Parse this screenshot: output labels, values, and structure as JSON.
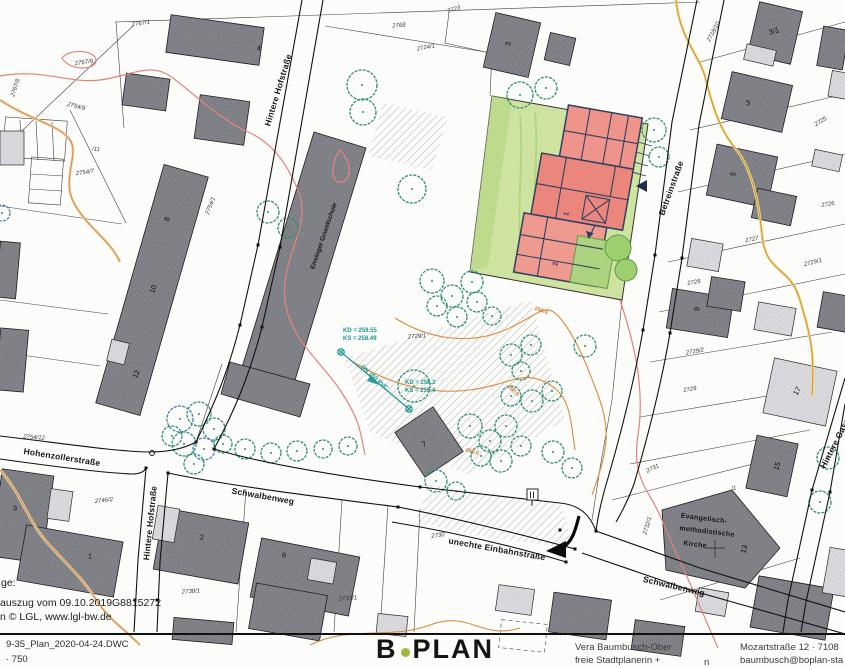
{
  "map": {
    "labels": [
      {
        "t": "Hintere Hofstraße",
        "x": 278,
        "y": 90,
        "r": -73,
        "c": "street",
        "n": "street-label-hintere-hofstrasse-north"
      },
      {
        "t": "Hintere Hofstraße",
        "x": 150,
        "y": 523,
        "r": -84,
        "c": "street",
        "n": "street-label-hintere-hofstrasse-south"
      },
      {
        "t": "Hohenzollerstraße",
        "x": 62,
        "y": 457,
        "r": 9,
        "c": "street",
        "n": "street-label-hohenzollerstrasse"
      },
      {
        "t": "Schwalbenweg",
        "x": 263,
        "y": 496,
        "r": 10,
        "c": "street",
        "n": "street-label-schwalbenweg-west"
      },
      {
        "t": "unechte Einbahnstraße",
        "x": 497,
        "y": 549,
        "r": 10,
        "c": "street",
        "n": "street-label-unechte-einbahnstrasse"
      },
      {
        "t": "Schwalbenweg",
        "x": 674,
        "y": 586,
        "r": 13,
        "c": "street",
        "n": "street-label-schwalbenweg-east"
      },
      {
        "t": "Betreinstraße",
        "x": 671,
        "y": 188,
        "r": -70,
        "c": "street",
        "n": "street-label-betreinstrasse"
      },
      {
        "t": "Hintere Gasse",
        "x": 836,
        "y": 441,
        "r": -63,
        "c": "street",
        "n": "street-label-hintere-gasse"
      },
      {
        "t": "Ensinger Grundschule",
        "x": 324,
        "y": 236,
        "r": -71,
        "c": "bname",
        "n": "building-label-grundschule"
      },
      {
        "t": "Evangelisch-",
        "x": 704,
        "y": 519,
        "r": 7,
        "c": "bname kirche",
        "n": "building-label-kirche-1"
      },
      {
        "t": "methodistische",
        "x": 707,
        "y": 532,
        "r": 7,
        "c": "bname kirche",
        "n": "building-label-kirche-2"
      },
      {
        "t": "Kirche",
        "x": 695,
        "y": 545,
        "r": 7,
        "c": "bname kirche",
        "n": "building-label-kirche-3"
      },
      {
        "t": "2767/1",
        "x": 141,
        "y": 24,
        "r": -8,
        "c": "parcel"
      },
      {
        "t": "2768",
        "x": 399,
        "y": 26,
        "r": -4,
        "c": "parcel"
      },
      {
        "t": "2767/9",
        "x": 84,
        "y": 63,
        "r": -8,
        "c": "parcel"
      },
      {
        "t": "2767/8",
        "x": 16,
        "y": 88,
        "r": -72,
        "c": "parcel"
      },
      {
        "t": "2754/9",
        "x": 76,
        "y": 107,
        "r": 14,
        "c": "parcel"
      },
      {
        "t": "/11",
        "x": 96,
        "y": 150,
        "r": 5,
        "c": "parcel"
      },
      {
        "t": "2754/7",
        "x": 85,
        "y": 173,
        "r": -8,
        "c": "parcel"
      },
      {
        "t": "2754/1",
        "x": 211,
        "y": 206,
        "r": -68,
        "c": "parcel"
      },
      {
        "t": "2754/12",
        "x": 34,
        "y": 438,
        "r": 4,
        "c": "parcel"
      },
      {
        "t": "2746/2",
        "x": 104,
        "y": 501,
        "r": -6,
        "c": "parcel"
      },
      {
        "t": "2738/1",
        "x": 191,
        "y": 592,
        "r": -4,
        "c": "parcel"
      },
      {
        "t": "2737/1",
        "x": 348,
        "y": 599,
        "r": -4,
        "c": "parcel"
      },
      {
        "t": "2723",
        "x": 454,
        "y": 10,
        "r": -16,
        "c": "parcel"
      },
      {
        "t": "2724/1",
        "x": 426,
        "y": 48,
        "r": -10,
        "c": "parcel"
      },
      {
        "t": "2725",
        "x": 821,
        "y": 122,
        "r": -32,
        "c": "parcel"
      },
      {
        "t": "2726",
        "x": 828,
        "y": 205,
        "r": -10,
        "c": "parcel"
      },
      {
        "t": "2727",
        "x": 752,
        "y": 240,
        "r": -12,
        "c": "parcel"
      },
      {
        "t": "2728",
        "x": 694,
        "y": 283,
        "r": -10,
        "c": "parcel"
      },
      {
        "t": "2729/1",
        "x": 813,
        "y": 263,
        "r": -14,
        "c": "parcel"
      },
      {
        "t": "2729/2",
        "x": 695,
        "y": 352,
        "r": -10,
        "c": "parcel"
      },
      {
        "t": "2729",
        "x": 690,
        "y": 390,
        "r": -10,
        "c": "parcel"
      },
      {
        "t": "2729/1",
        "x": 417,
        "y": 337,
        "r": -4,
        "c": "parcel"
      },
      {
        "t": "2730",
        "x": 438,
        "y": 536,
        "r": -8,
        "c": "parcel"
      },
      {
        "t": "2731",
        "x": 653,
        "y": 469,
        "r": -26,
        "c": "parcel"
      },
      {
        "t": "2732/1",
        "x": 648,
        "y": 526,
        "r": -74,
        "c": "parcel"
      },
      {
        "t": "/1",
        "x": 734,
        "y": 489,
        "r": -8,
        "c": "parcel"
      },
      {
        "t": "2718/10",
        "x": 714,
        "y": 32,
        "r": -62,
        "c": "parcel"
      },
      {
        "t": "4",
        "x": 259,
        "y": 48,
        "r": 0,
        "c": "bnum"
      },
      {
        "t": "3",
        "x": 508,
        "y": 44,
        "r": -78,
        "c": "bnum"
      },
      {
        "t": "3/1",
        "x": 774,
        "y": 31,
        "r": -14,
        "c": "bnum"
      },
      {
        "t": "3",
        "x": 748,
        "y": 103,
        "r": -14,
        "c": "bnum"
      },
      {
        "t": "5",
        "x": 733,
        "y": 174,
        "r": -74,
        "c": "bnum"
      },
      {
        "t": "9",
        "x": 697,
        "y": 309,
        "r": -76,
        "c": "bnum"
      },
      {
        "t": "17",
        "x": 797,
        "y": 391,
        "r": -60,
        "c": "bnum"
      },
      {
        "t": "15",
        "x": 777,
        "y": 466,
        "r": -74,
        "c": "bnum"
      },
      {
        "t": "13",
        "x": 744,
        "y": 549,
        "r": -74,
        "c": "bnum"
      },
      {
        "t": "8",
        "x": 167,
        "y": 219,
        "r": -70,
        "c": "bnum"
      },
      {
        "t": "10",
        "x": 153,
        "y": 289,
        "r": -70,
        "c": "bnum"
      },
      {
        "t": "12",
        "x": 136,
        "y": 374,
        "r": -70,
        "c": "bnum"
      },
      {
        "t": "3",
        "x": 15,
        "y": 508,
        "r": 0,
        "c": "bnum"
      },
      {
        "t": "1",
        "x": 90,
        "y": 556,
        "r": 0,
        "c": "bnum"
      },
      {
        "t": "2",
        "x": 202,
        "y": 537,
        "r": 0,
        "c": "bnum"
      },
      {
        "t": "6",
        "x": 284,
        "y": 555,
        "r": 0,
        "c": "bnum"
      },
      {
        "t": "7",
        "x": 424,
        "y": 444,
        "r": -25,
        "c": "bnum"
      },
      {
        "t": "1",
        "x": 567,
        "y": 214,
        "r": -80,
        "c": "rednum"
      },
      {
        "t": "2",
        "x": 556,
        "y": 264,
        "r": -80,
        "c": "rednum"
      },
      {
        "t": "259.0",
        "x": 541,
        "y": 311,
        "r": 20,
        "c": "contour"
      },
      {
        "t": "260.0",
        "x": 513,
        "y": 391,
        "r": 42,
        "c": "contour"
      },
      {
        "t": "261.0",
        "x": 472,
        "y": 452,
        "r": 15,
        "c": "contour"
      },
      {
        "t": "KD = 259.55",
        "x": 343,
        "y": 331,
        "r": 0,
        "c": "util",
        "a": "l"
      },
      {
        "t": "KS = 258.49",
        "x": 343,
        "y": 339,
        "r": 0,
        "c": "util",
        "a": "l"
      },
      {
        "t": "DN 150 PVC",
        "x": 374,
        "y": 378,
        "r": 42,
        "c": "util"
      },
      {
        "t": "KD = 258.2",
        "x": 405,
        "y": 383,
        "r": 0,
        "c": "util",
        "a": "l"
      },
      {
        "t": "KS = 255.4",
        "x": 405,
        "y": 391,
        "r": 0,
        "c": "util",
        "a": "l"
      },
      {
        "t": "ge:",
        "x": 1,
        "y": 583,
        "r": 0,
        "c": "note",
        "a": "l"
      },
      {
        "t": "auszug vom 09.10.2019",
        "x": 0,
        "y": 603,
        "r": 0,
        "c": "note",
        "a": "l"
      },
      {
        "t": "G8815272",
        "x": 112,
        "y": 603,
        "r": 0,
        "c": "note",
        "a": "l"
      },
      {
        "t": "n © LGL, www.lgl-bw.de",
        "x": 0,
        "y": 617,
        "r": 0,
        "c": "note",
        "a": "l"
      }
    ]
  },
  "footer": {
    "file_name": "9-35_Plan_2020-04-24.DWC",
    "scale": "· 750",
    "logo_b": "B",
    "logo_rest": "PLAN",
    "planner_name": "Vera Baumbusch-Ober",
    "planner_role": "freie Stadtplanerin +",
    "stray": "n",
    "address": "Mozartstraße 12 · 7108",
    "email": "baumbusch@boplan-sta"
  },
  "colors": {
    "contour_orange": "#dd8a3c",
    "contour_pink": "#e2837a",
    "utility_teal": "#2a9d94",
    "tree_green": "#2f8f72",
    "tree_blue": "#4a79b0",
    "lawn_green": "#cfe3a0",
    "building_red": "#ec8d82",
    "building_dark": "#828289",
    "building_light": "#d9d9de",
    "plan_navy": "#2e3f63",
    "logo_green": "#a2b83c"
  }
}
